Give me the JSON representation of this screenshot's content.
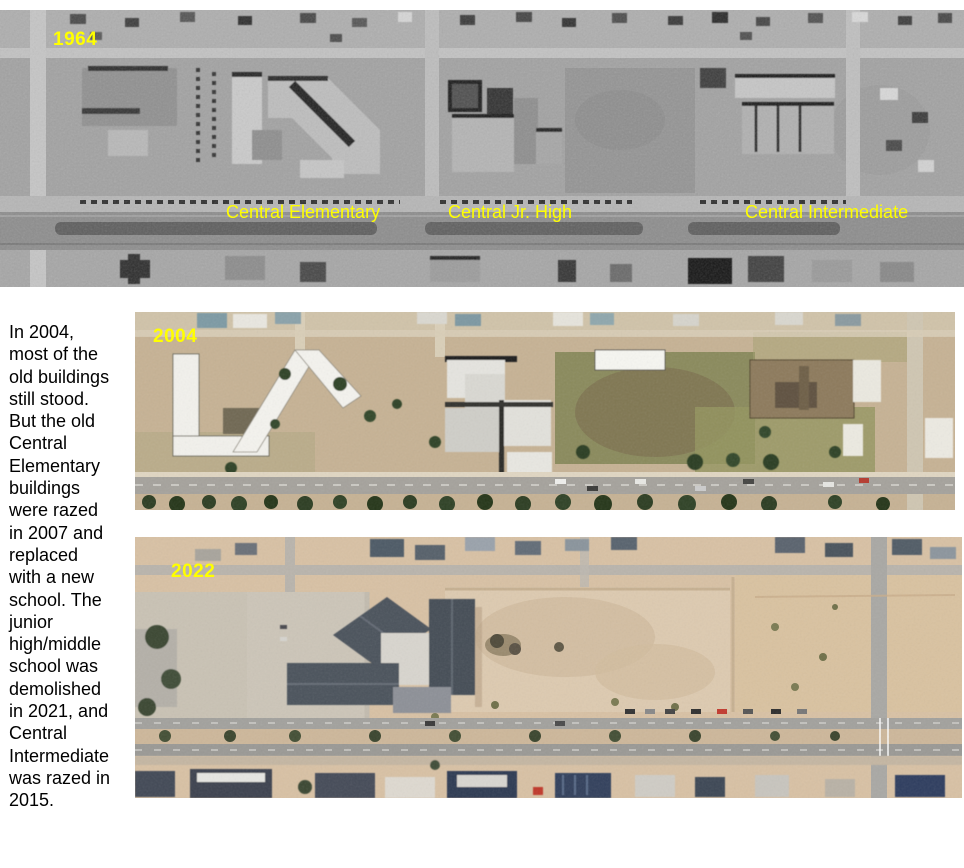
{
  "figure": {
    "description": "Three aerial photos of the Central schools corridor, 1964 / 2004 / 2022"
  },
  "caption": {
    "text": "In 2004,\nmost of the\nold buildings\nstill stood.\nBut the old\nCentral\nElementary\nbuildings\nwere razed\nin 2007 and\nreplaced\nwith a new\nschool. The\njunior\nhigh/middle\nschool was\ndemolished\nin 2021, and\nCentral\nIntermediate\nwas razed in\n2015."
  },
  "photos": {
    "p1964": {
      "year": "1964",
      "kind": "grayscale aerial photo",
      "labels": [
        {
          "text": "Central Elementary"
        },
        {
          "text": "Central Jr. High"
        },
        {
          "text": "Central Intermediate"
        }
      ]
    },
    "p2004": {
      "year": "2004",
      "kind": "color aerial photo"
    },
    "p2022": {
      "year": "2022",
      "kind": "color aerial photo"
    }
  },
  "colors": {
    "annotation_yellow": "#ffff00",
    "caption_text": "#000000",
    "page_background": "#ffffff"
  }
}
